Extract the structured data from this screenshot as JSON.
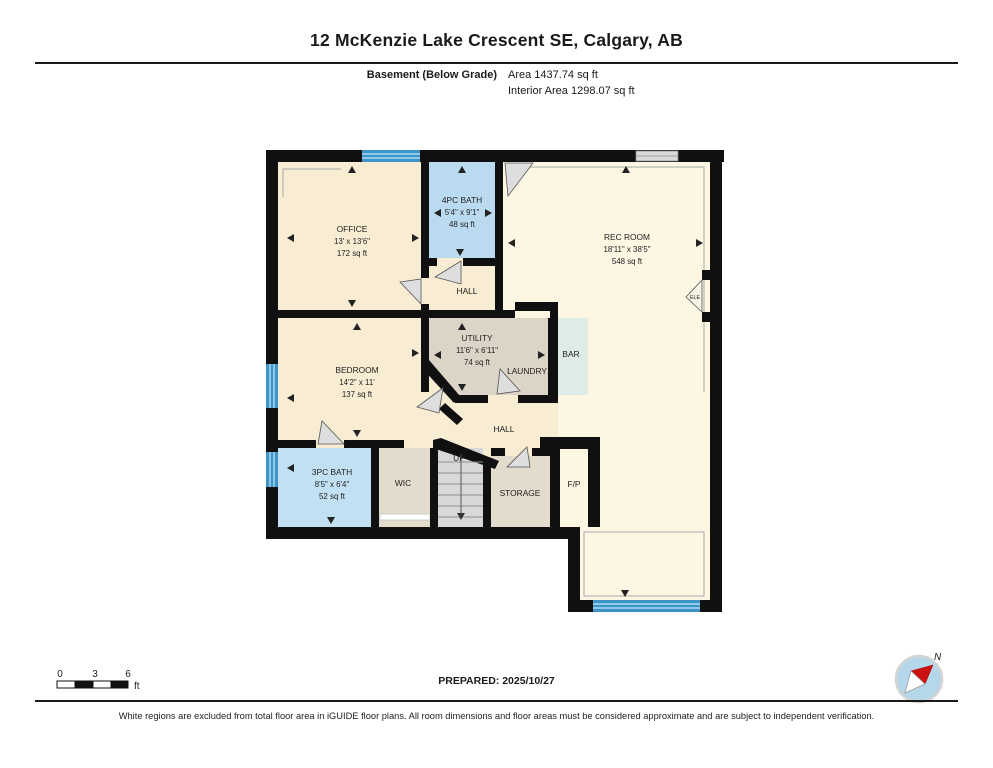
{
  "header": {
    "title": "12 McKenzie Lake Crescent SE, Calgary, AB",
    "floor_label": "Basement (Below Grade)",
    "area_label": "Area 1437.74 sq ft",
    "interior_area_label": "Interior Area 1298.07 sq ft"
  },
  "rooms": {
    "office": {
      "name": "OFFICE",
      "dims": "13' x 13'6\"",
      "area": "172 sq ft"
    },
    "bath4": {
      "name": "4PC BATH",
      "dims": "5'4\" x 9'1\"",
      "area": "48 sq ft"
    },
    "rec": {
      "name": "REC ROOM",
      "dims": "18'11\" x 38'5\"",
      "area": "548 sq ft"
    },
    "utility": {
      "name": "UTILITY",
      "dims": "11'6\" x 6'11\"",
      "area": "74 sq ft"
    },
    "bedroom": {
      "name": "BEDROOM",
      "dims": "14'2\" x 11'",
      "area": "137 sq ft"
    },
    "bath3": {
      "name": "3PC BATH",
      "dims": "8'5\" x 6'4\"",
      "area": "52 sq ft"
    },
    "hall_upper": "HALL",
    "hall_lower": "HALL",
    "laundry": "LAUNDRY",
    "bar": "BAR",
    "wic": "WIC",
    "storage": "STORAGE",
    "fireplace": "F/P",
    "up": "UP",
    "elec": "ELE"
  },
  "scale_bar": {
    "tick0": "0",
    "tick3": "3",
    "tick6": "6",
    "unit": "ft"
  },
  "footer": {
    "prepared": "PREPARED: 2025/10/27",
    "north": "N",
    "disclaimer": "White regions are excluded from total floor area in iGUIDE floor plans. All room dimensions and floor areas must be considered approximate and are subject to independent verification."
  },
  "colors": {
    "wall": "#101010",
    "room_warm_cream": "#f8ecd2",
    "rec_room_cream": "#fcf6e2",
    "bathroom_blue": "#badaf0",
    "utility_gray": "#dcd4c6",
    "closet_tan": "#e3dbcb",
    "bar_teal": "#dfece6",
    "window_blue": "#3d94c9",
    "compass_blue": "#b5d7ea",
    "compass_needle_red": "#cc1111"
  }
}
